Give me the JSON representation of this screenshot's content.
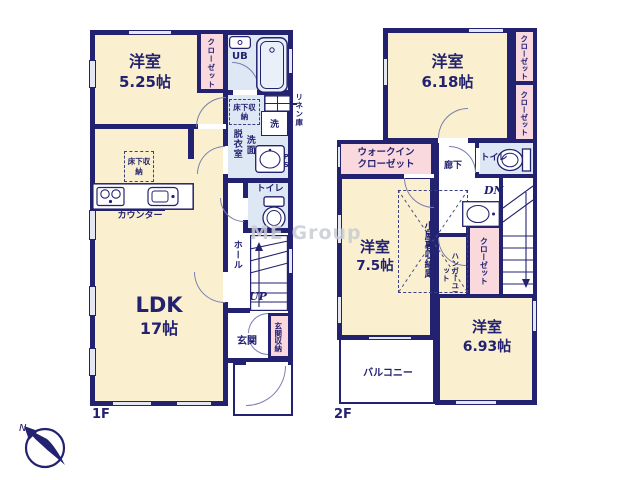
{
  "watermark": "ME Group",
  "compass": {
    "north": "N"
  },
  "colors": {
    "wall": "#232270",
    "cream": "#faf0cf",
    "pink": "#f9d9de",
    "blue": "#dde8f4",
    "window": "#e4e7f2",
    "watermark": "#c9ccd4",
    "arc": "#7a7fae"
  },
  "floor1": {
    "label": "1F",
    "room_525": {
      "name": "洋室",
      "size": "5.25帖"
    },
    "ldk": {
      "name": "LDK",
      "size": "17帖"
    },
    "closet": "クローゼット",
    "ub": "UB",
    "linen": "リネン庫",
    "underfloor_storage_wash": "床下収納",
    "underfloor_storage_ldk": "床下収納",
    "washer": "洗",
    "dressing_room": "脱衣室",
    "vanity": "洗面",
    "ps": "PS",
    "toilet": "トイレ",
    "hall": "ホール",
    "up": "UP",
    "entrance": "玄関",
    "entrance_storage": "玄関収納",
    "counter": "カウンター"
  },
  "floor2": {
    "label": "2F",
    "room_618": {
      "name": "洋室",
      "size": "6.18帖"
    },
    "room_75": {
      "name": "洋室",
      "size": "7.5帖"
    },
    "room_693": {
      "name": "洋室",
      "size": "6.93帖"
    },
    "closet_top": "クローゼット",
    "closet_mid": "クローゼット",
    "closet_stairs": "クローゼット",
    "walk_in_closet": "ウォークインクローゼット",
    "hallway": "廊下",
    "toilet": "トイレ",
    "dn": "DN",
    "attic_storage": "小屋裏収納庫",
    "hanger_unit": "ハンガーユニット",
    "balcony": "バルコニー"
  }
}
